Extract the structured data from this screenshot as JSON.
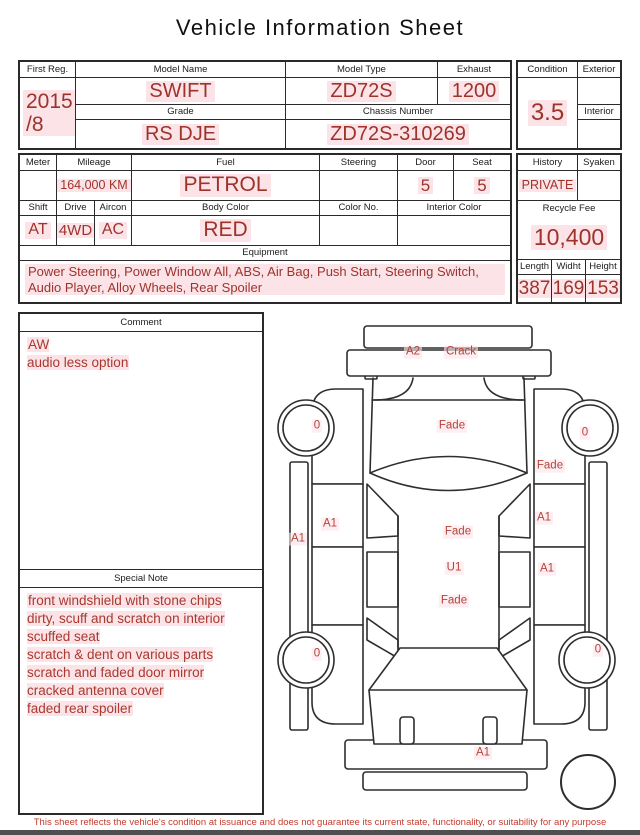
{
  "title": "Vehicle Information Sheet",
  "colors": {
    "value_red": "#9e332a",
    "note_red": "#a8392e",
    "disclaimer_red": "#c43a2e",
    "diagram_label_red": "#b2443a",
    "border_black": "#2a2a2a",
    "highlight_pink": "#fbe3e8"
  },
  "info": {
    "first_reg": {
      "label": "First Reg.",
      "value": "2015\n/8"
    },
    "model_name": {
      "label": "Model Name",
      "value": "SWIFT"
    },
    "model_type": {
      "label": "Model Type",
      "value": "ZD72S"
    },
    "exhaust": {
      "label": "Exhaust",
      "value": "1200"
    },
    "grade": {
      "label": "Grade",
      "value": "RS DJE"
    },
    "chassis_number": {
      "label": "Chassis Number",
      "value": "ZD72S-310269"
    },
    "condition": {
      "label": "Condition",
      "value": "3.5"
    },
    "exterior": {
      "label": "Exterior",
      "value": ""
    },
    "interior": {
      "label": "Interior",
      "value": ""
    }
  },
  "details": {
    "meter": {
      "label": "Meter",
      "value": ""
    },
    "mileage": {
      "label": "Mileage",
      "value": "164,000 KM"
    },
    "fuel": {
      "label": "Fuel",
      "value": "PETROL"
    },
    "steering": {
      "label": "Steering",
      "value": ""
    },
    "door": {
      "label": "Door",
      "value": "5"
    },
    "seat": {
      "label": "Seat",
      "value": "5"
    },
    "shift": {
      "label": "Shift",
      "value": "AT"
    },
    "drive": {
      "label": "Drive",
      "value": "4WD"
    },
    "aircon": {
      "label": "Aircon",
      "value": "AC"
    },
    "body_color": {
      "label": "Body Color",
      "value": "RED"
    },
    "color_no": {
      "label": "Color No.",
      "value": ""
    },
    "interior_color": {
      "label": "Interior Color",
      "value": ""
    },
    "equipment": {
      "label": "Equipment",
      "value": "Power Steering, Power Window  All, ABS, Air Bag, Push Start, Steering Switch, Audio Player, Alloy Wheels, Rear Spoiler"
    },
    "history": {
      "label": "History",
      "value": "PRIVATE"
    },
    "syaken": {
      "label": "Syaken",
      "value": ""
    },
    "recycle_fee": {
      "label": "Recycle Fee",
      "value": "10,400"
    },
    "length": {
      "label": "Length",
      "value": "387"
    },
    "width": {
      "label": "Widht",
      "value": "169"
    },
    "height": {
      "label": "Height",
      "value": "153"
    }
  },
  "comment": {
    "label": "Comment",
    "text": "AW\naudio less option"
  },
  "special_note": {
    "label": "Special Note",
    "text": "front windshield with stone chips\ndirty, scuff and scratch on interior\nscuffed seat\nscratch & dent on various parts\nscratch and faded door mirror\ncracked antenna cover\nfaded rear spoiler"
  },
  "diagram": {
    "labels": [
      {
        "text": "A2",
        "x": 143,
        "y": 40
      },
      {
        "text": "Crack",
        "x": 191,
        "y": 40
      },
      {
        "text": "0",
        "x": 47,
        "y": 114
      },
      {
        "text": "Fade",
        "x": 182,
        "y": 114
      },
      {
        "text": "0",
        "x": 315,
        "y": 121
      },
      {
        "text": "Fade",
        "x": 280,
        "y": 154
      },
      {
        "text": "A1",
        "x": 60,
        "y": 212
      },
      {
        "text": "A1",
        "x": 28,
        "y": 227
      },
      {
        "text": "A1",
        "x": 274,
        "y": 206
      },
      {
        "text": "Fade",
        "x": 188,
        "y": 220
      },
      {
        "text": "U1",
        "x": 184,
        "y": 256
      },
      {
        "text": "A1",
        "x": 277,
        "y": 257
      },
      {
        "text": "Fade",
        "x": 184,
        "y": 289
      },
      {
        "text": "0",
        "x": 47,
        "y": 342
      },
      {
        "text": "0",
        "x": 328,
        "y": 338
      },
      {
        "text": "A1",
        "x": 213,
        "y": 441
      }
    ]
  },
  "footer": {
    "disclaimer": "This sheet reflects the vehicle's condition at issuance and does not guarantee its current state, functionality, or suitability for any purpose"
  }
}
